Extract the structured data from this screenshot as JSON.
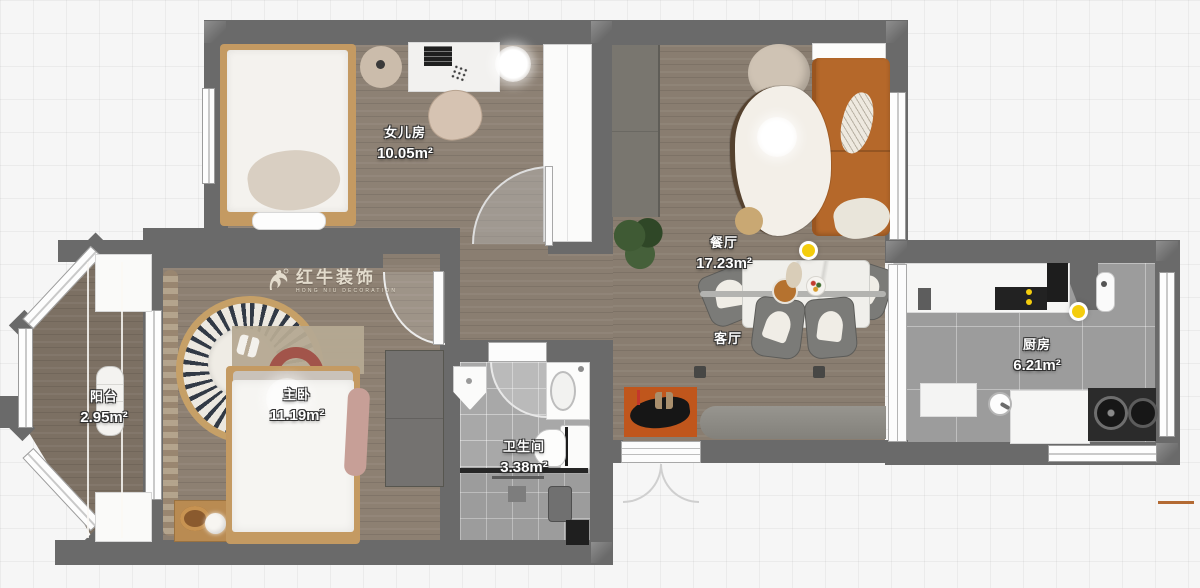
{
  "plan": {
    "type": "apartment-floor-plan",
    "watermark": {
      "brand": "红牛装饰",
      "subtitle": "HONG NIU DECORATION"
    },
    "rooms": [
      {
        "id": "daughter-room",
        "name": "女儿房",
        "area": "10.05m²"
      },
      {
        "id": "dining-room",
        "name": "餐厅",
        "area": "17.23m²"
      },
      {
        "id": "living-room",
        "name": "客厅",
        "area": ""
      },
      {
        "id": "balcony",
        "name": "阳台",
        "area": "2.95m²"
      },
      {
        "id": "master-bedroom",
        "name": "主卧",
        "area": "11.19m²"
      },
      {
        "id": "bathroom",
        "name": "卫生间",
        "area": "3.38m²"
      },
      {
        "id": "kitchen",
        "name": "厨房",
        "area": "6.21m²"
      }
    ],
    "colors": {
      "wall": "#6a6a6a",
      "wood_floor": "#8a7e71",
      "kitchen_tile": "#9c9c9c",
      "bath_tile": "#a8a8a8",
      "sofa_orange": "#b5682a",
      "doormat_orange": "#c0561c",
      "light_yellow": "#f4cd0e"
    }
  }
}
